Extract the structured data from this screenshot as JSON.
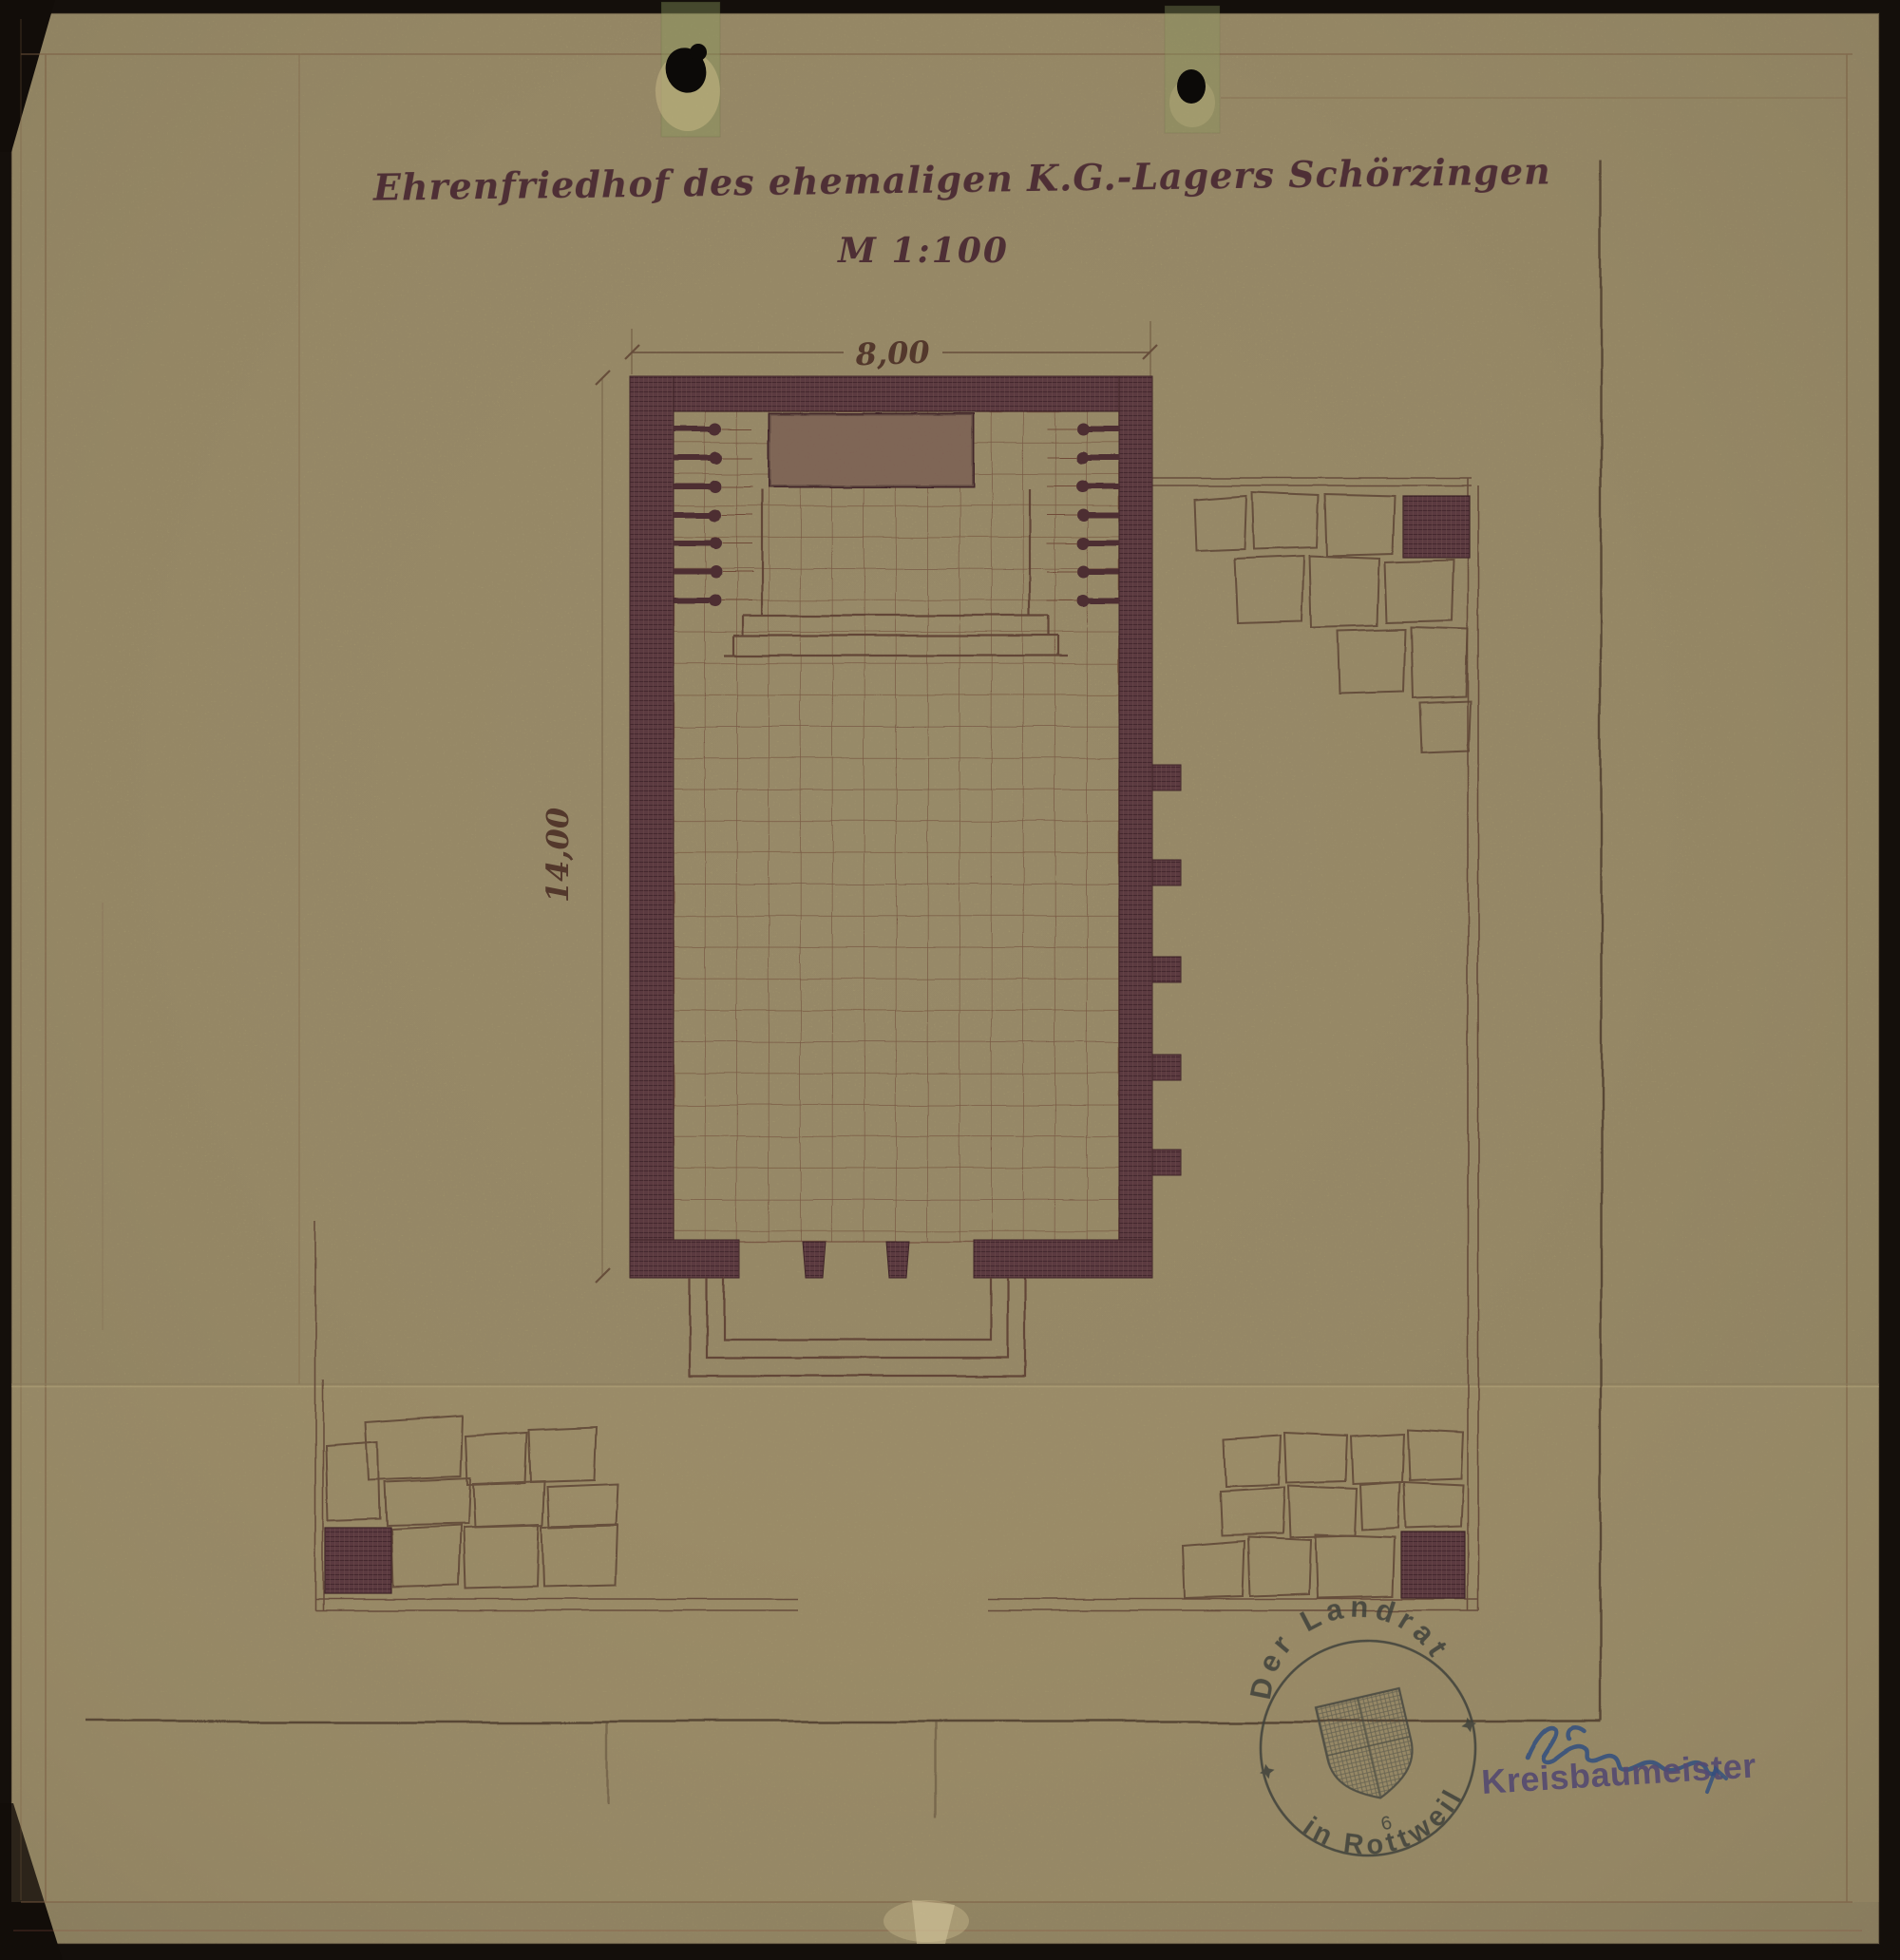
{
  "document": {
    "title": "Ehrenfriedhof des ehemaligen K.G.-Lagers Schörzingen",
    "scale_label": "M 1:100"
  },
  "dimensions": {
    "width_label": "8,00",
    "height_label": "14,00"
  },
  "stamps": {
    "round_stamp": {
      "top_text": "Der Landrat",
      "bottom_text": "in Rottweil",
      "center_number": "6"
    },
    "office_stamp_label": "Kreisbaumeister"
  },
  "colors": {
    "background": "#140f0b",
    "paper": "#a89b72",
    "wall_ink": "#5b3a40",
    "line_ink": "#6f4b38",
    "boundary_ink": "#4a372b",
    "title_ink": "#4e2f35",
    "round_stamp_ink": "#3d403a",
    "office_stamp_ink": "#544a71",
    "signature_ink": "#2f4e80"
  }
}
